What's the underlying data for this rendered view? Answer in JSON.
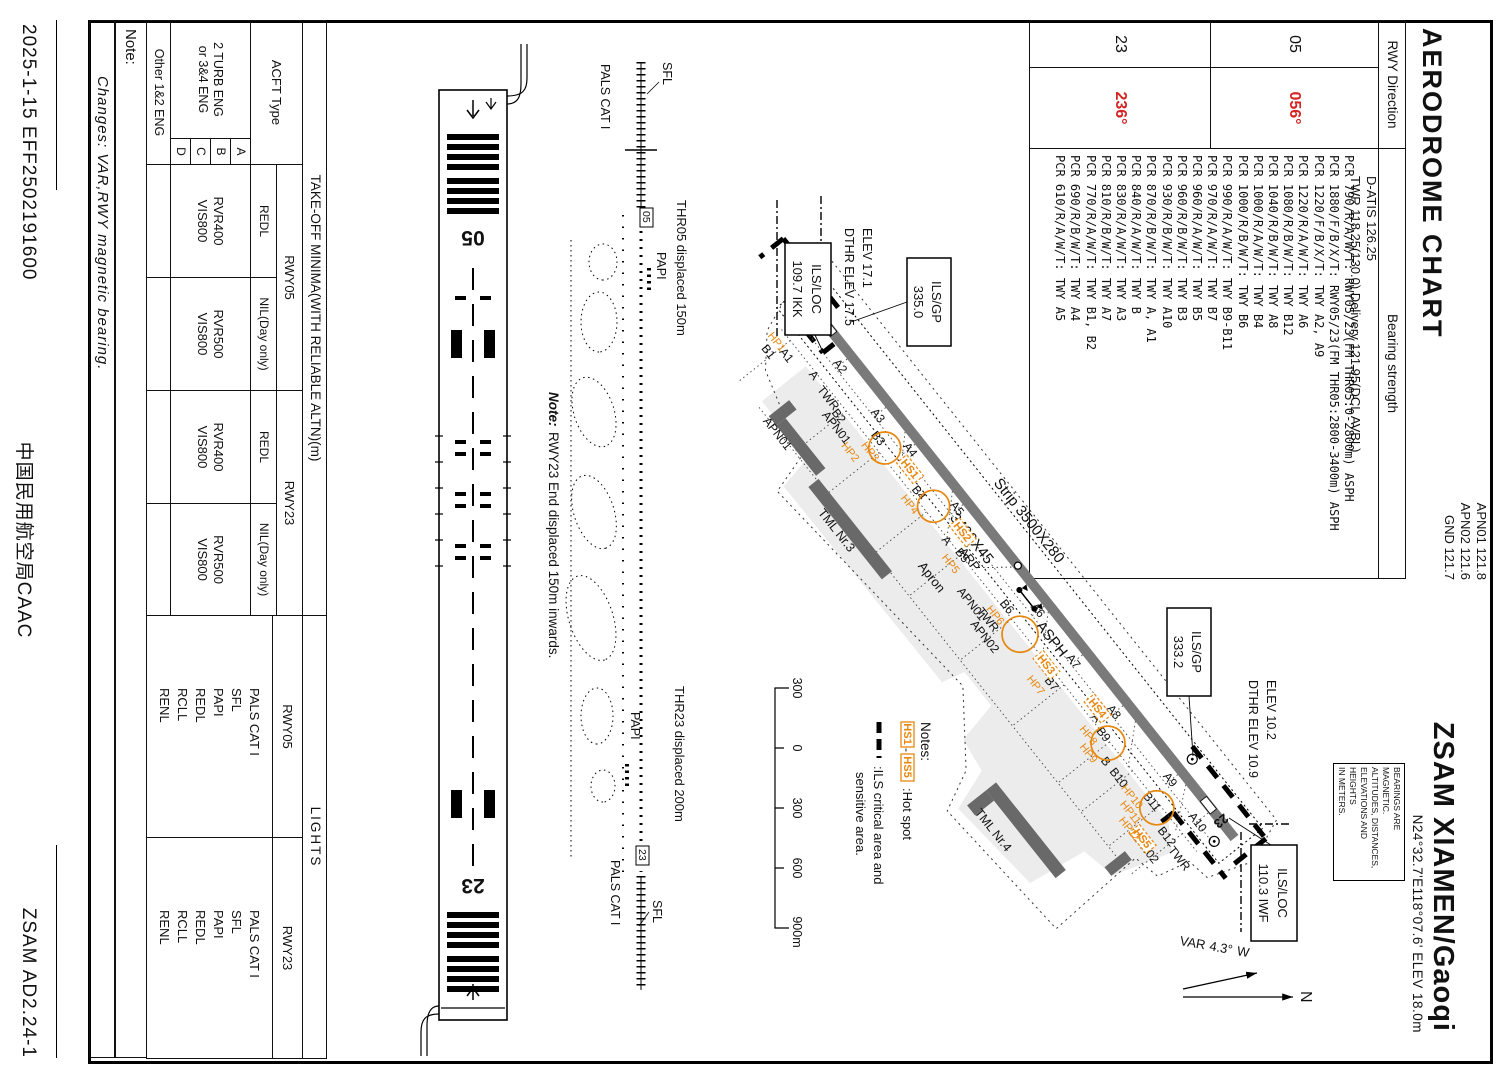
{
  "header": {
    "title": "AERODROME  CHART",
    "freq_left": [
      "D-ATIS 126.25",
      "TWR   118.25(130.0)  Delivery 121.95(DCL AVBL)"
    ],
    "freq_right": [
      "APN01 121.8",
      "APN02 121.6",
      "GND  121.7"
    ],
    "airport": "ZSAM  XIAMEN/Gaoqi",
    "coords": "N24°32.7'E118°07.6'   ELEV 18.0m",
    "units_note": [
      "BEARINGS ARE MAGNETIC.",
      "ALTITUDES, DISTANCES,",
      "ELEVATIONS AND HEIGHTS",
      "IN METERS."
    ]
  },
  "bearing_table": {
    "header_rwy": "RWY Direction",
    "header_strength": "Bearing strength",
    "rows": [
      {
        "rwy": "05",
        "bearing": "056°"
      },
      {
        "rwy": "23",
        "bearing": "236°"
      }
    ],
    "pcr_lines": [
      "PCR 790/R/A/W/T: RWY05/23(FM THR05:0-2800m) ASPH",
      "PCR 1880/F/B/X/T: RWY05/23(FM THR05:2800-3400m) ASPH",
      "PCR 1220/F/B/X/T: TWY A2, A9",
      "PCR 1220/R/A/W/T: TWY A6",
      "PCR 1080/R/B/W/T: TWY B12",
      "PCR 1040/R/B/W/T: TWY A8",
      "PCR 1000/R/A/W/T: TWY B4",
      "PCR 1000/R/B/W/T: TWY B6",
      "PCR 990/R/A/W/T: TWY B9-B11",
      "PCR 970/R/A/W/T: TWY B7",
      "PCR 960/R/A/W/T: TWY B5",
      "PCR 960/R/B/W/T: TWY B3",
      "PCR 930/R/B/W/T: TWY A10",
      "PCR 870/R/B/W/T: TWY A, A1",
      "PCR 840/R/A/W/T: TWY B",
      "PCR 830/R/A/W/T: TWY A3",
      "PCR 810/R/B/W/T: TWY A7",
      "PCR 770/R/A/W/T: TWY B1, B2",
      "PCR 690/R/B/W/T: TWY A4",
      "PCR 610/R/A/W/T: TWY A5"
    ]
  },
  "map": {
    "strip": "Strip 3500X280",
    "rwy_dim": "3400X45",
    "surface": "ASPH",
    "arp": "ARP",
    "apron": "Apron",
    "rwy05": "05",
    "rwy23": "23",
    "twy_a": [
      "A1",
      "A2",
      "A3",
      "A4",
      "A5",
      "A6",
      "A7",
      "A8",
      "A9",
      "A10"
    ],
    "twy_b": [
      "B1",
      "B2",
      "B3",
      "B4",
      "B5",
      "B6",
      "B7",
      "B9",
      "B10",
      "B11",
      "B12"
    ],
    "a_single": "A",
    "b_single": "B",
    "twr": "TWR",
    "apn01": "APN01",
    "apn02": "APN02",
    "tml3": "TML Nr.3",
    "tml4": "TML Nr.4",
    "hp": [
      "HP1",
      "HP2",
      "HP3",
      "HP4",
      "HP5",
      "HP6",
      "HP7",
      "HP8",
      "HP9",
      "HP10",
      "HP11",
      "HP12"
    ],
    "hs": [
      "HS1",
      "HS2",
      "HS3",
      "HS4",
      "HS5"
    ],
    "ils_gp05": [
      "ILS/GP",
      "335.0"
    ],
    "ils_loc05": [
      "ILS/LOC",
      "109.7 IKK"
    ],
    "ils_gp23": [
      "ILS/GP",
      "333.2"
    ],
    "ils_loc23": [
      "ILS/LOC",
      "110.3 IWF"
    ],
    "elev05": [
      "ELEV 17.1",
      "DTHR ELEV 17.5"
    ],
    "elev23": [
      "ELEV 10.2",
      "DTHR ELEV 10.9"
    ],
    "notes_title": "Notes:",
    "notes_hs_from": "HS1",
    "notes_hs_dash": "-",
    "notes_hs_to": "HS5",
    "notes_hot": ":Hot spot",
    "notes_ils1": ":ILS critical area and",
    "notes_ils2": "sensitive area.",
    "scale_labels": [
      "300",
      "0",
      "300",
      "600",
      "900m"
    ],
    "north_n": "N",
    "var_prefix": "VAR",
    "var_value": "4.3°",
    "var_suffix": "W"
  },
  "lights_diagram": {
    "sfl05": "SFL",
    "pals05": "PALS CAT I",
    "papi05": "PAPI",
    "thr05_note": "THR05 displaced 150m",
    "rwy05": "05",
    "sfl23": "SFL",
    "pals23": "PALS CAT I",
    "papi23": "PAPI",
    "thr23_note": "THR23 displaced 200m",
    "rwy23": "23",
    "note_label": "Note:",
    "note_text": "RWY23 End displaced 150m inwards."
  },
  "minima_table": {
    "title": "TAKE-OFF MINIMA(WITH RELIABLE ALTN)(m)",
    "acft": "ACFT Type",
    "rwy05": "RWY05",
    "rwy23": "RWY23",
    "redl": "REDL",
    "nil": "NIL(Day only)",
    "group_label": [
      "2 TURB ENG",
      "or 3&4 ENG"
    ],
    "cats": [
      "A",
      "B",
      "C",
      "D"
    ],
    "v_redl05": [
      "RVR400",
      "VIS800"
    ],
    "v_nil05": [
      "RVR500",
      "VIS800"
    ],
    "v_redl23": [
      "RVR400",
      "VIS800"
    ],
    "v_nil23": [
      "RVR500",
      "VIS800"
    ],
    "other": "Other 1&2 ENG"
  },
  "lights_table": {
    "title": "LIGHTS",
    "rwy05": "RWY05",
    "rwy23": "RWY23",
    "vals05": [
      "PALS CAT I",
      "SFL",
      "PAPI",
      "REDL",
      "RCLL",
      "RENL"
    ],
    "vals23": [
      "PALS CAT I",
      "SFL",
      "PAPI",
      "REDL",
      "RCLL",
      "RENL"
    ]
  },
  "footer": {
    "note_label": "Note:",
    "changes": "Changes: VAR,RWY magnetic bearing.",
    "date": "2025-1-15  EFF2502191600",
    "authority": "中国民用航空局CAAC",
    "doc": "ZSAM  AD2.24-1"
  }
}
